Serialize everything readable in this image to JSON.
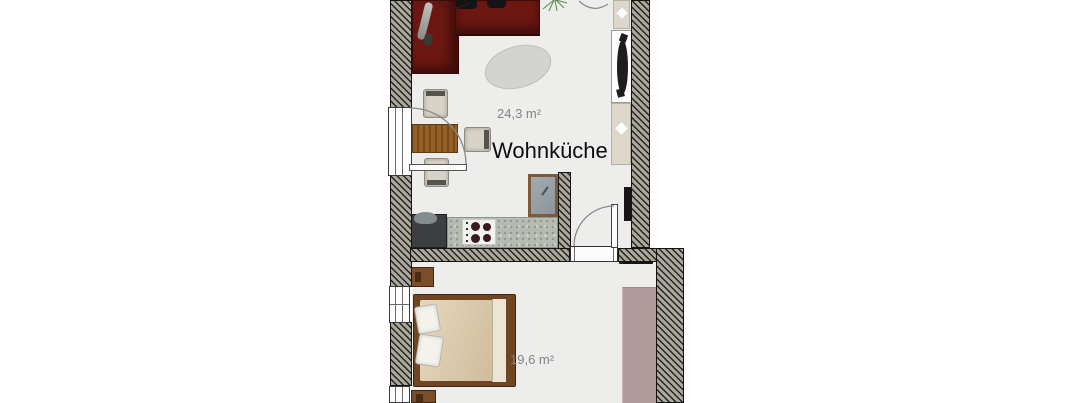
{
  "floorplan": {
    "rooms": [
      {
        "id": "wohnkueche",
        "name": "Wohnküche",
        "area": "24,3 m²"
      },
      {
        "id": "schlafzimmer",
        "name": "",
        "area": "19,6 m²"
      }
    ],
    "objects": [
      "corner-sofa",
      "floor-lamp",
      "rug",
      "plant",
      "dining-table",
      "chair",
      "kitchen-counter",
      "stove",
      "sink-unit",
      "tall-appliance",
      "radiator",
      "bed",
      "pillow",
      "nightstand",
      "wardrobe",
      "door",
      "window"
    ],
    "colors": {
      "background": "#ffffff",
      "floor": "#ededeb",
      "wall_fill": "#aba79c",
      "wall_hatch": "#23231f",
      "sofa": "#6d1712",
      "rug": "#d3d3d1",
      "table_wood": "#956026",
      "chair": "#d7d3c7",
      "counter_granite": "#b5bbb3",
      "stove": "#f1f1ef",
      "burner": "#3a1a1e",
      "dark_kitchen_unit": "#3c3e3f",
      "appliance_frame": "#7d5a3a",
      "appliance_fill": "#97a0a6",
      "radiator_block": "#dcd7ca",
      "radiator_dark": "#1a1a1a",
      "bed_frame": "#6f4524",
      "mattress": "#d9c7ad",
      "pillow": "#f4f2ed",
      "wardrobe": "#b29a9c",
      "nightstand": "#7a4e28",
      "room_label_text": "#0d0d0d",
      "area_text": "#838383",
      "door_arc": "#888888",
      "plant_green": "#5a8a4a"
    }
  }
}
